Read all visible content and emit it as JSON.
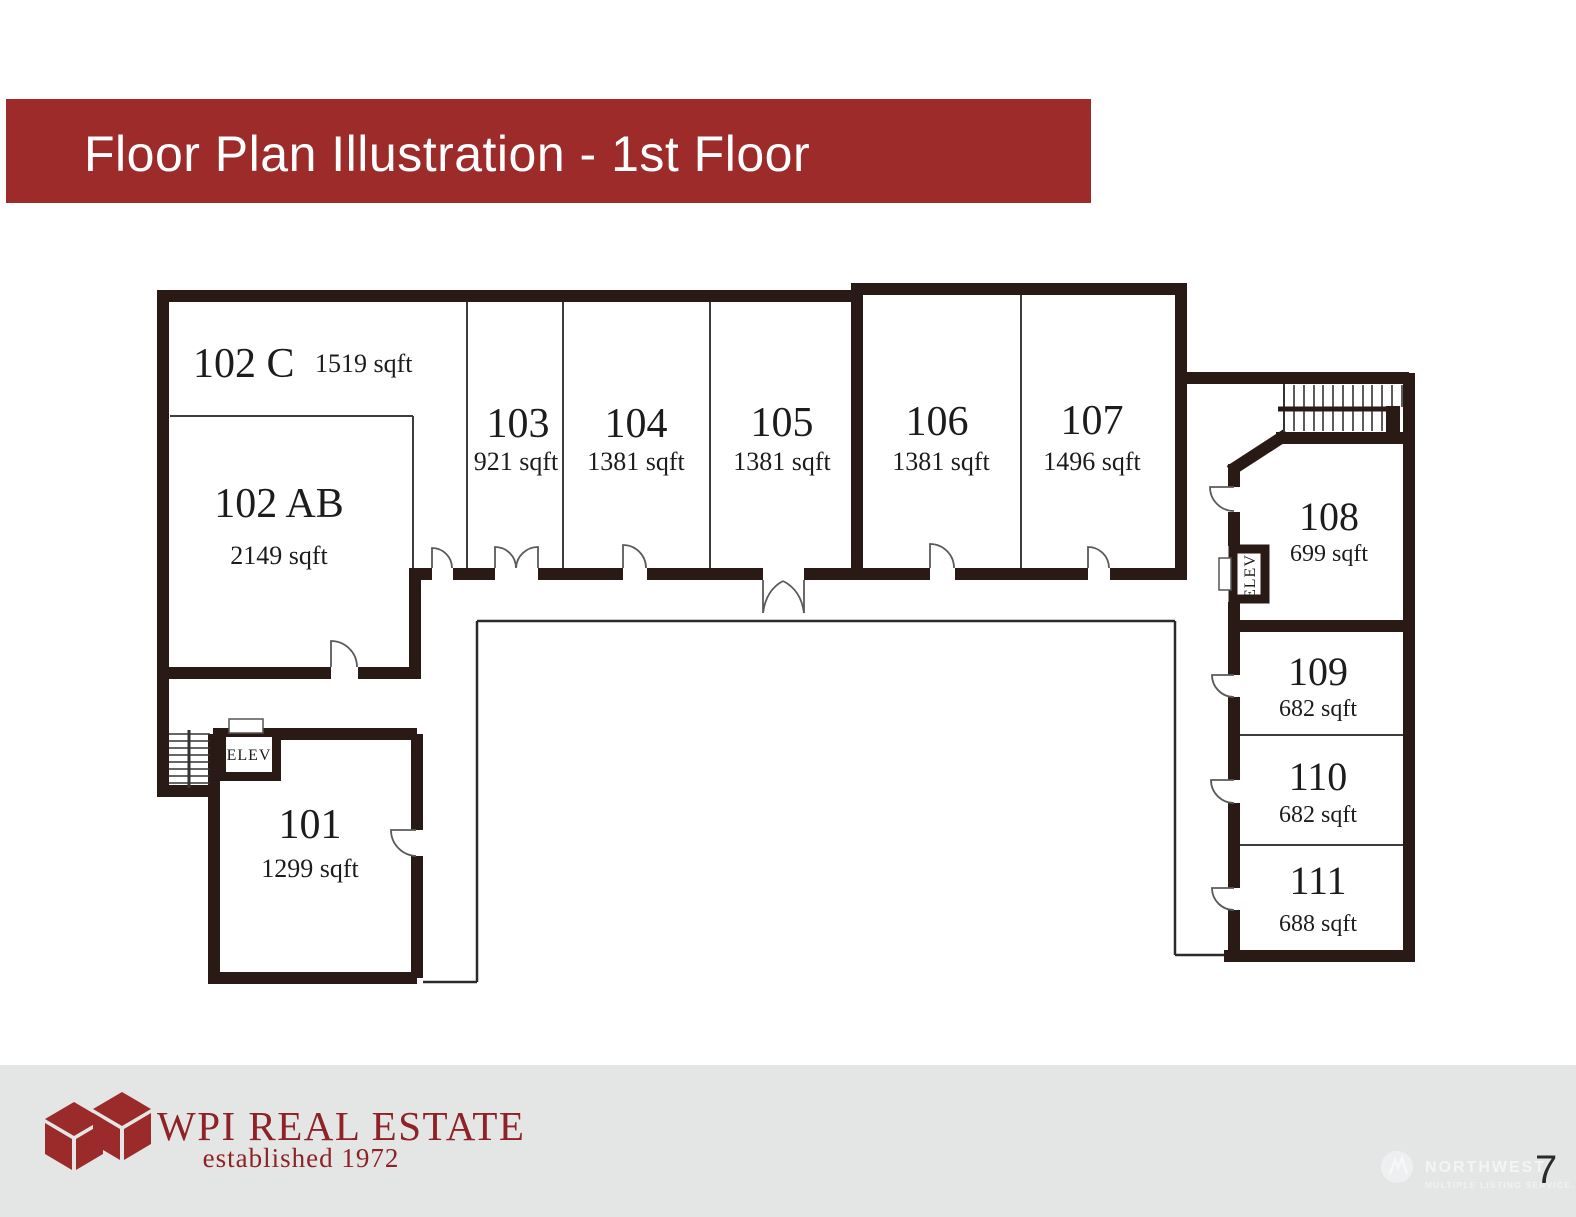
{
  "slide": {
    "title": "Floor Plan Illustration - 1st Floor",
    "page_number": "7"
  },
  "rooms": {
    "r102c": {
      "number": "102 C",
      "sqft": "1519 sqft"
    },
    "r102ab": {
      "number": "102 AB",
      "sqft": "2149 sqft"
    },
    "r103": {
      "number": "103",
      "sqft": "921 sqft"
    },
    "r104": {
      "number": "104",
      "sqft": "1381 sqft"
    },
    "r105": {
      "number": "105",
      "sqft": "1381 sqft"
    },
    "r106": {
      "number": "106",
      "sqft": "1381 sqft"
    },
    "r107": {
      "number": "107",
      "sqft": "1496 sqft"
    },
    "r108": {
      "number": "108",
      "sqft": "699 sqft"
    },
    "r109": {
      "number": "109",
      "sqft": "682 sqft"
    },
    "r110": {
      "number": "110",
      "sqft": "682 sqft"
    },
    "r111": {
      "number": "111",
      "sqft": "688 sqft"
    },
    "r101": {
      "number": "101",
      "sqft": "1299 sqft"
    }
  },
  "plan_labels": {
    "elev_left": "ELEV",
    "elev_right": "ELEV"
  },
  "footer": {
    "company": "WPI REAL ESTATE",
    "tagline": "established 1972"
  },
  "watermark": {
    "name": "NORTHWEST",
    "subtitle": "MULTIPLE LISTING SERVICE."
  },
  "colors": {
    "banner": "#9c2b2a",
    "wall": "#2a1a16",
    "logo_red": "#9b2b2b",
    "footer_bg": "#e4e6e6"
  }
}
